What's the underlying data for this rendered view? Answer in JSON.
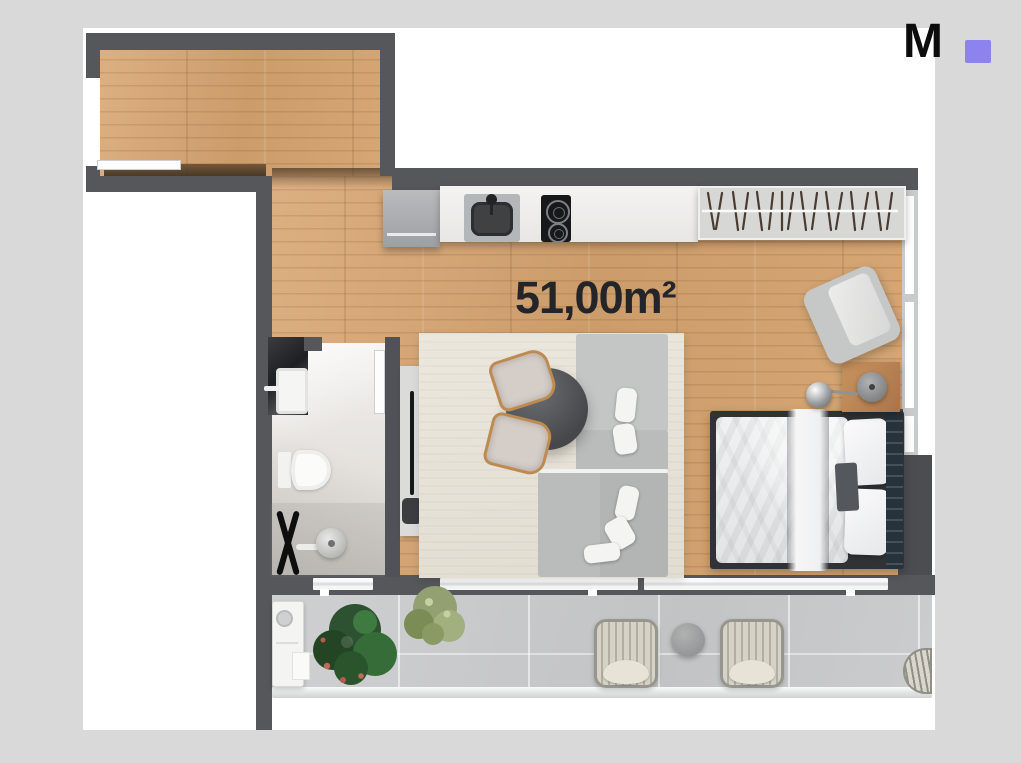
{
  "canvas": {
    "background_color": "#d9d9d9",
    "page_color": "#ffffff"
  },
  "logo": {
    "text": "M",
    "text_color": "#0c0c0c",
    "square_color": "#8c82f0"
  },
  "plan": {
    "area_label": "51,00m²"
  },
  "colors": {
    "canvas": "#d9d9d9",
    "page": "#ffffff",
    "logo": "#0c0c0c",
    "accent": "#8c82f0",
    "wall": "#56575b",
    "wall_dark": "#4c4d51",
    "wood": "#d3a26f",
    "marble_light": "#e9e7e3",
    "marble_dark": "#2c2d31",
    "tile": "#c9cacc",
    "rug": "#e8e4da",
    "sofa": "#b9baba",
    "cushion": "#f4f4f3",
    "linen": "#eceded",
    "headboard": "#26323c",
    "counter": "#f1f0ee",
    "appliance": "#a9abad",
    "wardrobe": "#d7d7d6",
    "table_top": "#55585b",
    "chair_wood": "#bf8a50",
    "plant_dark": "#2d5030",
    "plant_light": "#8e9b6d",
    "wicker": "#d6d2c6",
    "glass": "#f2f3f4"
  }
}
